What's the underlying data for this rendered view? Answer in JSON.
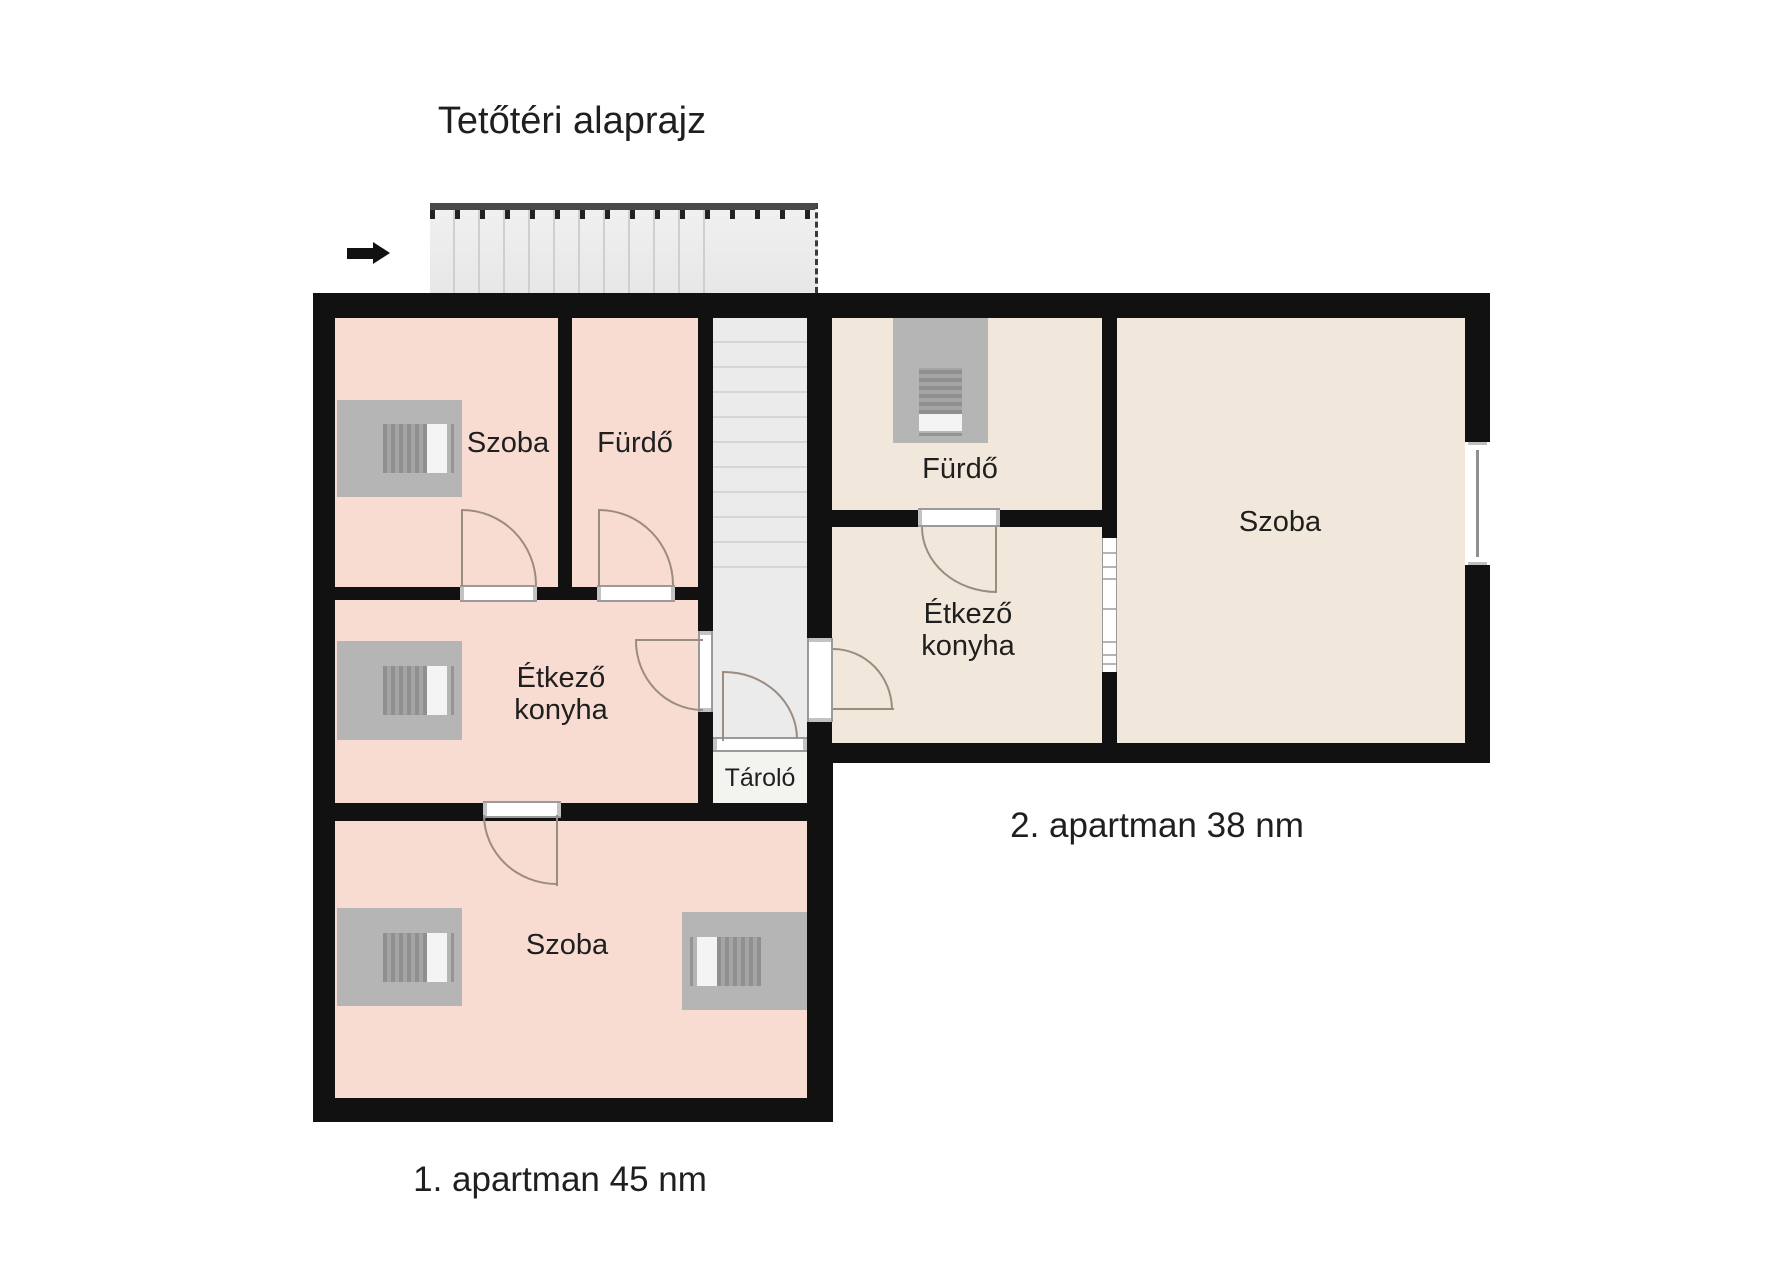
{
  "title": "Tetőtéri alaprajz",
  "legend": {
    "apartment1_label": "1. apartman 45 nm",
    "apartment2_label": "2. apartman 38 nm"
  },
  "rooms": {
    "apt1_szoba_top": "Szoba",
    "apt1_furdo": "Fürdő",
    "apt1_etkezo_konyha": "Étkező konyha",
    "apt1_szoba_bottom": "Szoba",
    "apt2_furdo": "Fürdő",
    "apt2_etkezo_konyha": "Étkező konyha",
    "apt2_szoba": "Szoba",
    "tarolo": "Tároló"
  },
  "icons": {
    "entry_arrow": "right-arrow-icon",
    "roof_window": "roof-window-icon",
    "staircase_top": "staircase-run",
    "staircase_shaft": "staircase-shaft"
  },
  "colors": {
    "wall": "#111111",
    "apt1_room_fill": "#f8dcd2",
    "apt2_room_fill": "#f1e8db",
    "stairs_fill": "#ebebeb",
    "storage_fill": "#f3f3ef",
    "door_arc": "#9c8c80",
    "roof_window_gray": "#b5b5b5",
    "text": "#1f1f1f"
  }
}
